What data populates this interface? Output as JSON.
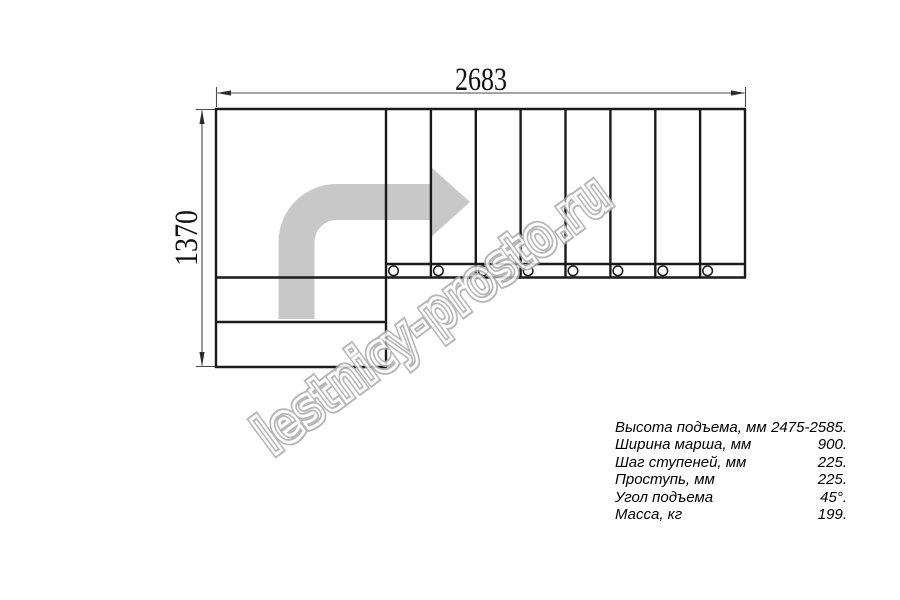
{
  "page": {
    "background": "#ffffff"
  },
  "drawing": {
    "width_label": "2683",
    "height_label": "1370",
    "flight": {
      "tread_count": 8,
      "bolt_hole_count": 8
    },
    "colors": {
      "outline": "#1a1a1a",
      "dimension": "#4a4a4a",
      "direction_arrow": "#c8c8c8",
      "watermark": "#ababab"
    }
  },
  "watermark": {
    "text": "lestnicy-prosto.ru"
  },
  "specs": {
    "rows": [
      {
        "label": "Высота подъема, мм",
        "value": "2475-2585."
      },
      {
        "label": "Ширина марша, мм",
        "value": "900."
      },
      {
        "label": "Шаг ступеней, мм",
        "value": "225."
      },
      {
        "label": "Проступь, мм",
        "value": "225."
      },
      {
        "label": "Угол подъема",
        "value": "45°."
      },
      {
        "label": "Масса, кг",
        "value": "199."
      }
    ]
  }
}
